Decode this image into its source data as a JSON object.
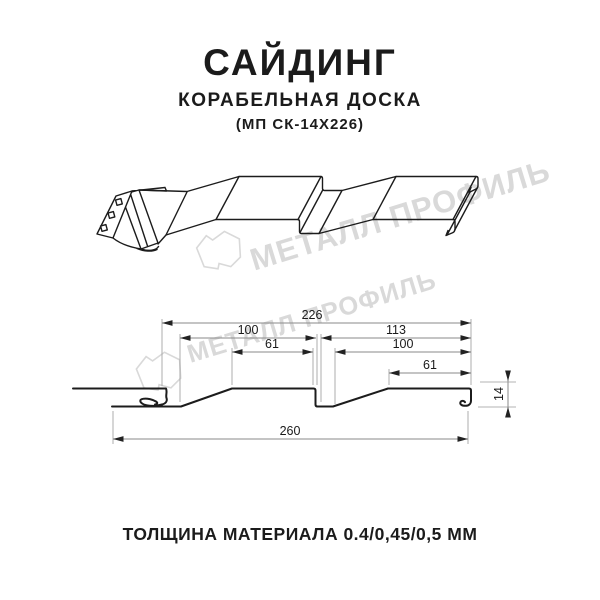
{
  "header": {
    "title": "САЙДИНГ",
    "subtitle": "КОРАБЕЛЬНАЯ ДОСКА",
    "model": "(МП СК-14Х226)"
  },
  "watermark": {
    "brand": "МЕТАЛЛ ПРОФИЛЬ"
  },
  "footer": {
    "thickness_note": "ТОЛЩИНА МАТЕРИАЛА 0.4/0,45/0,5 ММ"
  },
  "diagram": {
    "dimensions": {
      "total_top": "226",
      "left_panel_base": "100",
      "right_section": "113",
      "left_panel_top": "61",
      "right_panel_base": "100",
      "right_panel_top": "61",
      "overall_width": "260",
      "profile_height": "14"
    }
  },
  "colors": {
    "line": "#1c1c1c",
    "dimension_line": "#8a8a8a",
    "arrow": "#222222",
    "watermark": "#d9d9d9",
    "text": "#1b1b1b"
  }
}
